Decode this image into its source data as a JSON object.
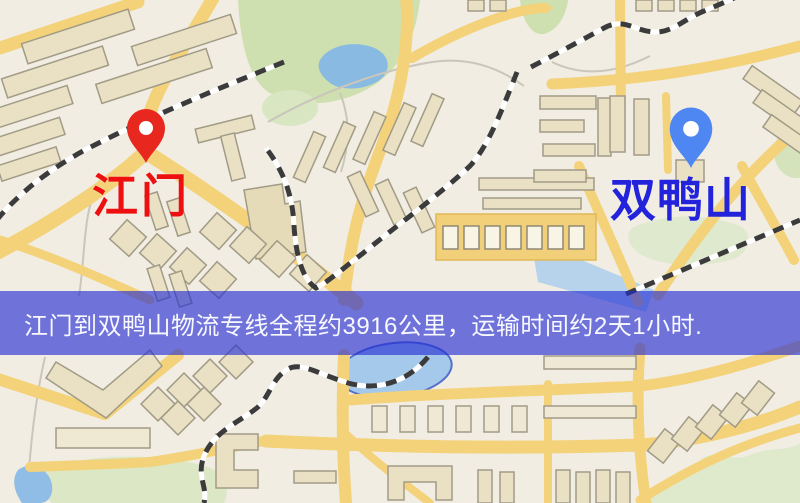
{
  "map": {
    "origin": {
      "label": "江门",
      "label_color": "#ee1010",
      "pin_color": "#e8281e",
      "icon": "map-pin-icon"
    },
    "destination": {
      "label": "双鸭山",
      "label_color": "#2323dc",
      "pin_color": "#4f87f2",
      "icon": "map-pin-icon"
    },
    "banner": {
      "text": "江门到双鸭山物流专线全程约3916公里，运输时间约2天1小时.",
      "bg_color": "rgba(35,45,210,0.63)",
      "text_color": "#f8f8ff"
    }
  }
}
